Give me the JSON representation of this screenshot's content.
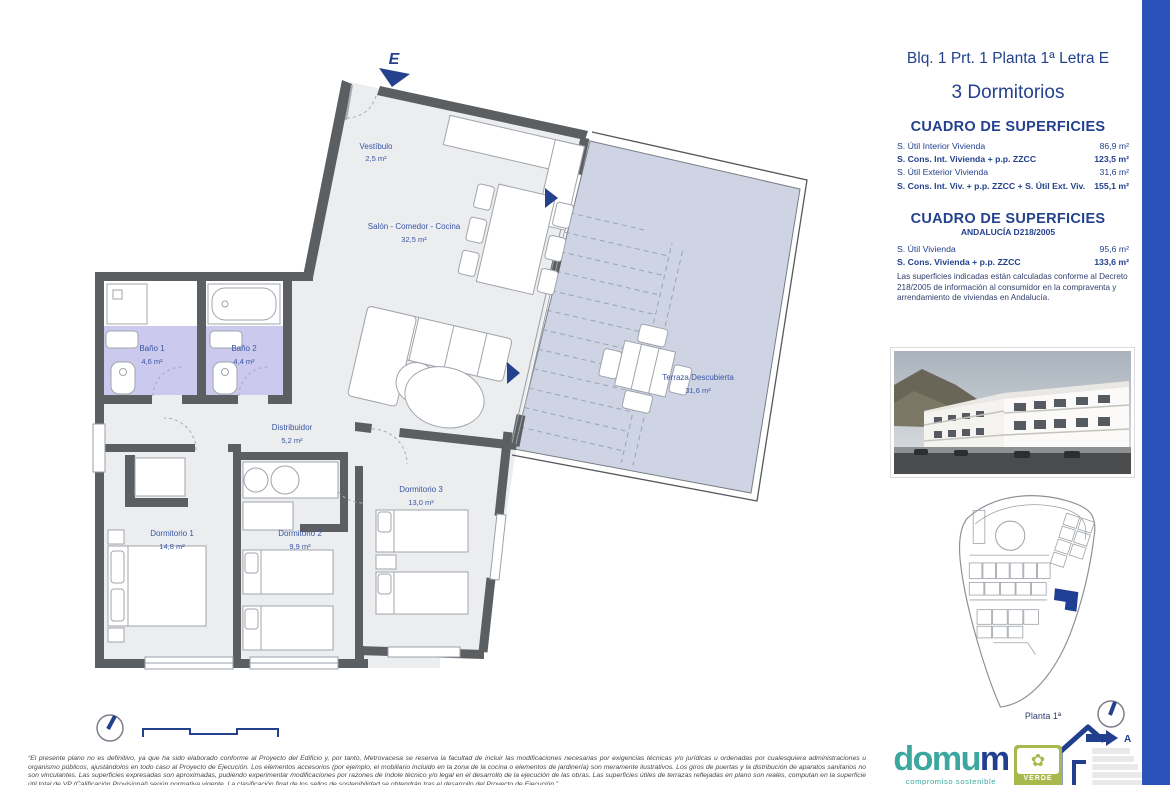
{
  "header": {
    "block_line": "Blq. 1 Prt. 1 Planta 1ª Letra E",
    "type_line": "3 Dormitorios"
  },
  "surfaces_main": {
    "title": "CUADRO DE SUPERFICIES",
    "rows": [
      {
        "label": "S. Útil Interior Vivienda",
        "value": "86,9 m²"
      },
      {
        "label": "S. Cons. Int. Vivienda + p.p. ZZCC",
        "value": "123,5 m²"
      },
      {
        "label": "S. Útil Exterior Vivienda",
        "value": "31,6 m²"
      },
      {
        "label": "S. Cons. Int. Viv. + p.p. ZZCC + S. Útil Ext. Viv.",
        "value": "155,1 m²"
      }
    ]
  },
  "surfaces_andalucia": {
    "title": "CUADRO DE SUPERFICIES",
    "subtitle": "ANDALUCÍA D218/2005",
    "rows": [
      {
        "label": "S. Útil Vivienda",
        "value": "95,6 m²"
      },
      {
        "label": "S. Cons. Vivienda + p.p. ZZCC",
        "value": "133,6 m²"
      }
    ],
    "note": "Las superficies indicadas están calculadas conforme al Decreto 218/2005 de información al consumidor en la compraventa y arrendamiento de viviendas en Andalucía."
  },
  "floor_plan": {
    "entrance_label": "E",
    "rooms": {
      "vestibulo": {
        "name": "Vestíbulo",
        "area": "2,5 m²"
      },
      "salon": {
        "name": "Salón - Comedor - Cocina",
        "area": "32,5 m²"
      },
      "bano1": {
        "name": "Baño 1",
        "area": "4,6 m²"
      },
      "bano2": {
        "name": "Baño 2",
        "area": "4,4 m²"
      },
      "distribuidor": {
        "name": "Distribuidor",
        "area": "5,2 m²"
      },
      "dorm1": {
        "name": "Dormitorio 1",
        "area": "14,8 m²"
      },
      "dorm2": {
        "name": "Dormitorio 2",
        "area": "9,9 m²"
      },
      "dorm3": {
        "name": "Dormitorio 3",
        "area": "13,0 m²"
      },
      "terraza": {
        "name": "Terraza Descubierta",
        "area": "31,6 m²"
      }
    }
  },
  "site_plan": {
    "caption": "Planta 1ª"
  },
  "legal": {
    "disclaimer": "“El presente plano no es definitivo, ya que ha sido elaborado conforme al Proyecto del Edificio y, por tanto, Metrovacesa se reserva la facultad de incluir las modificaciones necesarias por exigencias técnicas y/o jurídicas u ordenadas por cualesquiera administraciones u organismo públicos, ajustándolos en todo caso al Proyecto de Ejecución. Los elementos accesorios (por ejemplo, el mobiliario incluido en la zona de la cocina o elementos de jardinería) son meramente ilustrativos. Los giros de puertas y la distribución de aparatos sanitarios no son vinculantes. Las superficies expresadas son aproximadas, pudiendo experimentar modificaciones por razones de índole técnico y/o legal en el desarrollo de la ejecución de las obras. Las superficies útiles de terrazas reflejadas en plano son reales, computan en la superficie útil total de VP (Calificación Provisional) según normativa vigente. La clasificación final de los sellos de sostenibilidad se obtendrán tras el desarrollo del Proyecto de Ejecución.”"
  },
  "branding": {
    "domum_prefix": "domu",
    "domum_suffix": "m",
    "domum_tagline": "compromiso sostenible",
    "verde_label": "VERDE",
    "energy_rating_letter": "A"
  },
  "colors": {
    "navy": "#24418e",
    "royal_bar": "#2b52b9",
    "teal": "#3ba79f",
    "verde_green": "#a8b84c",
    "wall_gray": "#5c5f62",
    "bath_fill": "#cbc9ee",
    "terrace_fill": "#ced4e3",
    "room_fill": "#ecedee"
  }
}
